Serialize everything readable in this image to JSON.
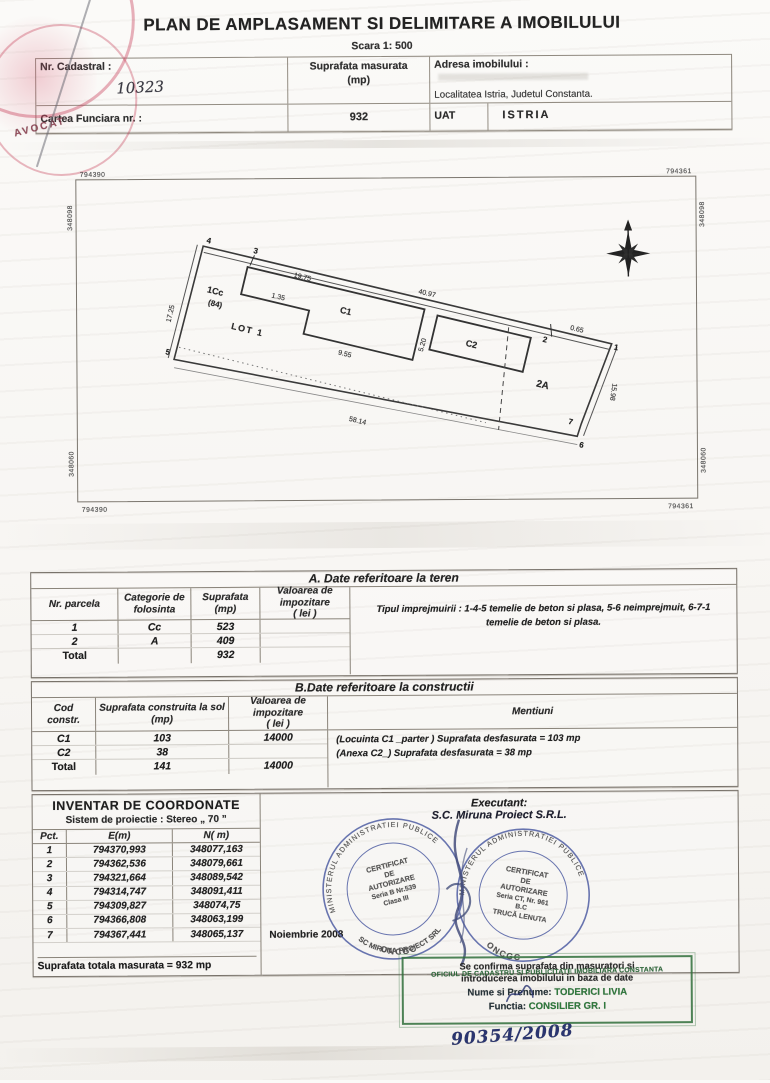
{
  "doc": {
    "title": "PLAN DE AMPLASAMENT SI DELIMITARE A IMOBILULUI",
    "scale": "Scara 1: 500"
  },
  "header": {
    "nr_cadastral_label": "Nr. Cadastral :",
    "nr_cadastral_value": "10323",
    "suprafata_label": "Suprafata masurata",
    "suprafata_unit": "(mp)",
    "suprafata_value": "932",
    "adresa_label": "Adresa imobilului :",
    "adresa_value": "Localitatea Istria, Judetul Constanta.",
    "cartea_funciara_label": "Cartea Funciara nr. :",
    "uat_label": "UAT",
    "uat_value": "ISTRIA"
  },
  "plan": {
    "grid": {
      "top_left_e": "794390",
      "top_right_e": "794361",
      "bottom_left_e": "794390",
      "bottom_right_e": "794361",
      "top_left_n": "348098",
      "top_right_n": "348098",
      "bottom_left_n": "348060",
      "bottom_right_n": "348060"
    },
    "labels": {
      "zone1": "1Cc",
      "zone1_sub": "(84)",
      "lot": "LOT  1",
      "c1": "C1",
      "c2": "C2",
      "zone2": "2A"
    },
    "dims": {
      "top": "40.97",
      "c1_width": "19.75",
      "step": "1.35",
      "c1_bottom": "9.55",
      "c1_right": "5.20",
      "near_p2": "0.65",
      "bottom": "58.14",
      "left": "17.25",
      "right": "15.98"
    },
    "points": {
      "p1": "1",
      "p2": "2",
      "p3": "3",
      "p4": "4",
      "p5": "5",
      "p6": "6",
      "p7": "7"
    }
  },
  "table_a": {
    "title": "A. Date referitoare la teren",
    "headers": [
      "Nr. parcela",
      "Categorie de\nfolosinta",
      "Suprafata\n(mp)",
      "Valoarea de impozitare\n( lei )",
      "Mentiuni"
    ],
    "rows": [
      [
        "1",
        "Cc",
        "523",
        ""
      ],
      [
        "2",
        "A",
        "409",
        ""
      ],
      [
        "Total",
        "",
        "932",
        ""
      ]
    ],
    "mentiuni": "Tipul imprejmuirii : 1-4-5 temelie de beton si plasa, 5-6 neimprejmuit, 6-7-1  temelie de beton si plasa."
  },
  "table_b": {
    "title": "B.Date referitoare la constructii",
    "headers": [
      "Cod\nconstr.",
      "Suprafata construita la sol\n(mp)",
      "Valoarea de impozitare\n( lei )",
      "Mentiuni"
    ],
    "rows": [
      [
        "C1",
        "103",
        "14000"
      ],
      [
        "C2",
        "38",
        ""
      ],
      [
        "Total",
        "141",
        "14000"
      ]
    ],
    "mentiuni_line1": "(Locuinta C1 _parter ) Suprafata desfasurata = 103  mp",
    "mentiuni_line2": "(Anexa C2_) Suprafata desfasurata  = 38 mp"
  },
  "coordinates": {
    "title": "INVENTAR DE COORDONATE",
    "subtitle": "Sistem de proiectie : Stereo „ 70 ”",
    "headers": [
      "Pct.",
      "E(m)",
      "N( m)"
    ],
    "rows": [
      [
        "1",
        "794370,993",
        "348077,163"
      ],
      [
        "2",
        "794362,536",
        "348079,661"
      ],
      [
        "3",
        "794321,664",
        "348089,542"
      ],
      [
        "4",
        "794314,747",
        "348091,411"
      ],
      [
        "5",
        "794309,827",
        "348074,75"
      ],
      [
        "6",
        "794366,808",
        "348063,199"
      ],
      [
        "7",
        "794367,441",
        "348065,137"
      ]
    ],
    "total": "Suprafata totala masurata = 932 mp"
  },
  "executant": {
    "label": "Executant:",
    "name": "S.C. Miruna Proiect S.R.L.",
    "date": "Noiembrie 2008"
  },
  "stamps": {
    "left": {
      "ring": "MINISTERUL  ADMINISTRATIEI  PUBLICE",
      "line1": "CERTIFICAT",
      "line2": "DE",
      "line3": "AUTORIZARE",
      "line4": "Seria B Nr.539",
      "line5": "Clasa III",
      "company": "SC MIRUNA PROIECT SRL",
      "bottom": "ONCGC"
    },
    "right": {
      "ring": "MINISTERUL  ADMINISTRATIEI  PUBLICE",
      "line1": "CERTIFICAT",
      "line2": "DE",
      "line3": "AUTORIZARE",
      "line4": "Seria CT, Nr. 961",
      "line5": "B.C",
      "line6": "TRUCĂ LENUTA",
      "bottom": "ONCGC"
    },
    "red_text": "AVOCAT"
  },
  "confirmation": {
    "line1": "Se confirma  suprafata din masuratori si",
    "line2": "introducerea imobilului in baza de date",
    "stamp_overlay": "OFICIUL DE CADASTRU SI PUBLICITATE IMOBILIARA CONSTANTA",
    "name_label": "Nume si Prenume:",
    "name_value": "TODERICI LIVIA",
    "function_label": "Functia:",
    "function_value": "CONSILIER GR. I",
    "number": "90354/2008"
  }
}
